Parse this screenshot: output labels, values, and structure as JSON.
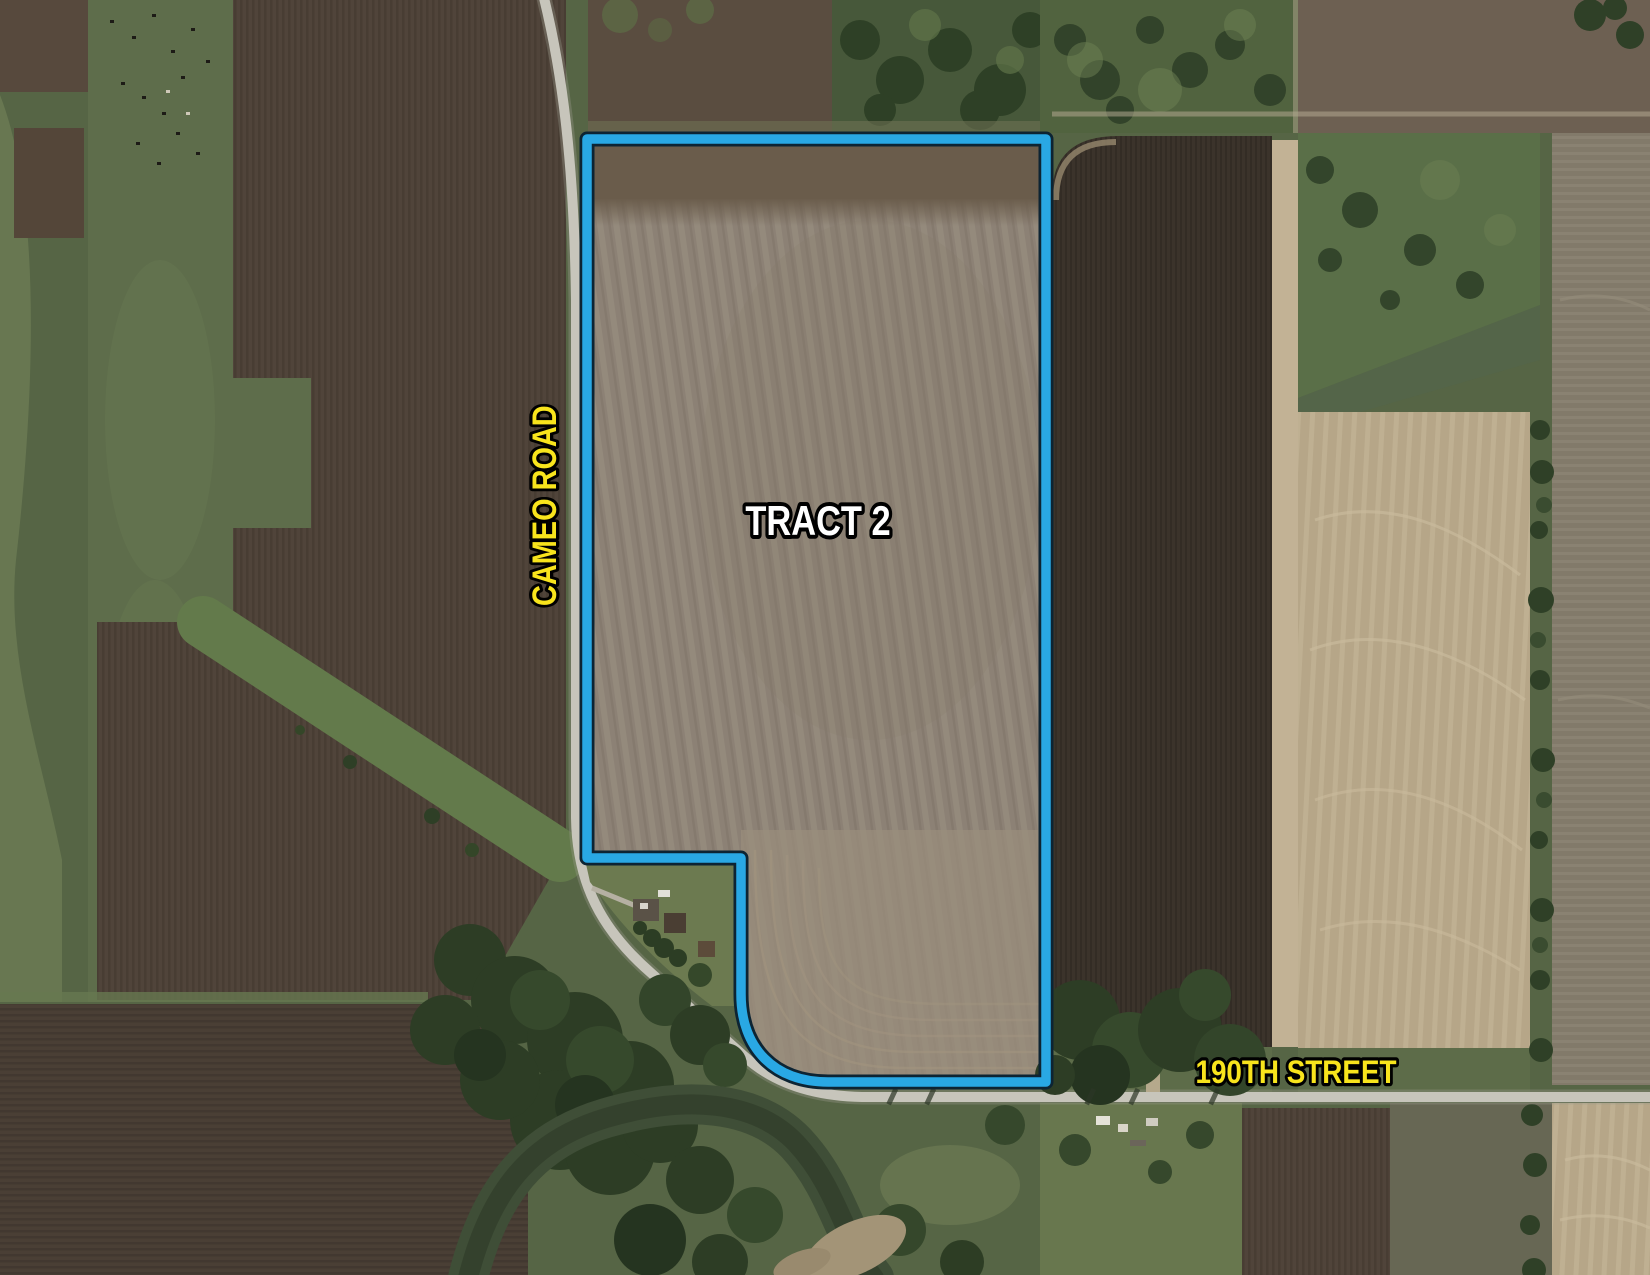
{
  "map": {
    "labels": {
      "tract": "TRACT 2",
      "road_vertical": "CAMEO ROAD",
      "road_horizontal": "190TH STREET"
    },
    "colors": {
      "boundary": "#29a8e4",
      "boundary_edge": "#0d2433",
      "road_label": "#f8e41c",
      "tract_label": "#ffffff",
      "label_outline": "#000000"
    }
  }
}
